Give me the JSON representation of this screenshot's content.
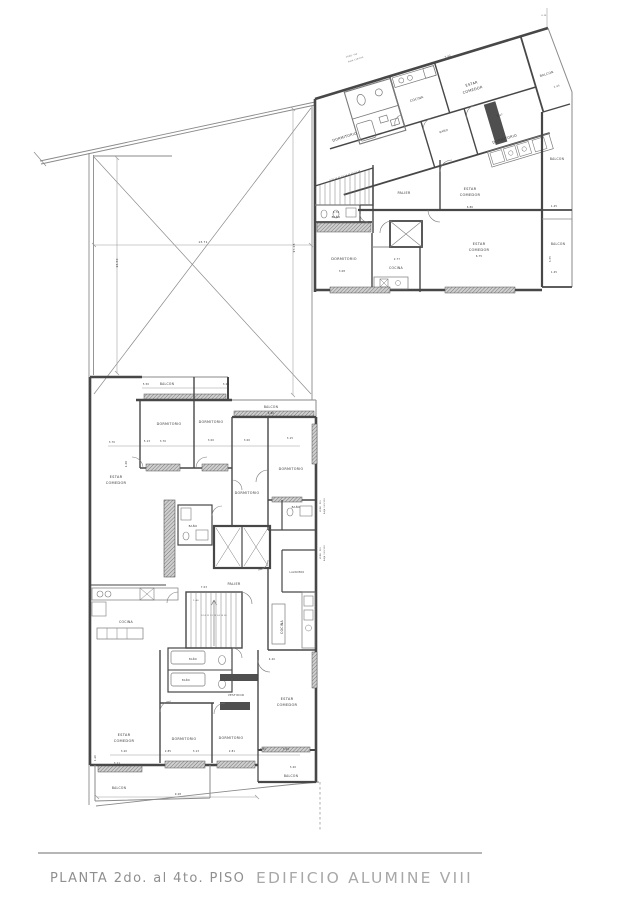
{
  "title": {
    "left": "PLANTA  2do.  al  4to.  PISO",
    "right": "EDIFICIO  ALUMINE  VIII"
  },
  "colors": {
    "wall": "#474747",
    "thin_line": "#8a8a8a",
    "title_left": "#8f8f8f",
    "title_right": "#a8a8a8",
    "background": "#ffffff"
  },
  "plan": {
    "labels": [
      {
        "t": "ESTAR",
        "x": 472,
        "y": 85,
        "r": -17,
        "s": 3.6,
        "c": "room"
      },
      {
        "t": "COMEDOR",
        "x": 473,
        "y": 91,
        "r": -17,
        "s": 3.6,
        "c": "room"
      },
      {
        "t": "COCINA",
        "x": 417,
        "y": 100,
        "r": -17,
        "s": 3.2,
        "c": "room"
      },
      {
        "t": "BALCON",
        "x": 547,
        "y": 75,
        "r": -17,
        "s": 3.1,
        "c": "room"
      },
      {
        "t": "DORMITORIO",
        "x": 345,
        "y": 138,
        "r": -17,
        "s": 3.5,
        "c": "room"
      },
      {
        "t": "BAÑO",
        "x": 444,
        "y": 132,
        "r": -17,
        "s": 2.7,
        "c": "room"
      },
      {
        "t": "DORMITORIO",
        "x": 505,
        "y": 140,
        "r": -17,
        "s": 3.5,
        "c": "room"
      },
      {
        "t": "BALCON",
        "x": 557,
        "y": 160,
        "s": 3.1,
        "c": "room"
      },
      {
        "t": "BALCON",
        "x": 558,
        "y": 245,
        "s": 3.1,
        "c": "room"
      },
      {
        "t": "PALIER",
        "x": 404,
        "y": 194,
        "s": 3.4,
        "c": "room"
      },
      {
        "t": "ESTAR",
        "x": 470,
        "y": 190,
        "s": 3.6,
        "c": "room"
      },
      {
        "t": "COMEDOR",
        "x": 470,
        "y": 196,
        "s": 3.6,
        "c": "room"
      },
      {
        "t": "BAÑO",
        "x": 336,
        "y": 218,
        "s": 2.7,
        "c": "room"
      },
      {
        "t": "DORMITORIO",
        "x": 344,
        "y": 260,
        "s": 3.5,
        "c": "room"
      },
      {
        "t": "COCINA",
        "x": 396,
        "y": 269,
        "s": 3.2,
        "c": "room"
      },
      {
        "t": "ESTAR",
        "x": 479,
        "y": 245,
        "s": 3.6,
        "c": "room"
      },
      {
        "t": "COMEDOR",
        "x": 479,
        "y": 251,
        "s": 3.6,
        "c": "room"
      },
      {
        "t": "BALCON",
        "x": 167,
        "y": 385,
        "s": 3.1,
        "c": "room"
      },
      {
        "t": "BALCON",
        "x": 271,
        "y": 408,
        "s": 3.1,
        "c": "room"
      },
      {
        "t": "DORMITORIO",
        "x": 169,
        "y": 425,
        "s": 3.4,
        "c": "room"
      },
      {
        "t": "DORMITORIO",
        "x": 211,
        "y": 423,
        "s": 3.4,
        "c": "room"
      },
      {
        "t": "ESTAR",
        "x": 116,
        "y": 478,
        "s": 3.6,
        "c": "room"
      },
      {
        "t": "COMEDOR",
        "x": 116,
        "y": 484,
        "s": 3.6,
        "c": "room"
      },
      {
        "t": "DORMITORIO",
        "x": 291,
        "y": 470,
        "s": 3.4,
        "c": "room"
      },
      {
        "t": "DORMITORIO",
        "x": 247,
        "y": 494,
        "s": 3.4,
        "c": "room"
      },
      {
        "t": "BAÑO",
        "x": 193,
        "y": 527,
        "s": 2.7,
        "c": "room"
      },
      {
        "t": "BAÑO",
        "x": 296,
        "y": 508,
        "s": 2.7,
        "c": "room"
      },
      {
        "t": "LAVADERO",
        "x": 297,
        "y": 573,
        "s": 2.4,
        "c": "room"
      },
      {
        "t": "PALIER",
        "x": 234,
        "y": 585,
        "s": 3.4,
        "c": "room"
      },
      {
        "t": "COCINA",
        "x": 126,
        "y": 623,
        "s": 3.2,
        "c": "room"
      },
      {
        "t": "COCINA",
        "x": 283,
        "y": 627,
        "r": -90,
        "s": 3.2,
        "c": "room"
      },
      {
        "t": "BAÑO",
        "x": 193,
        "y": 660,
        "s": 2.4,
        "c": "room"
      },
      {
        "t": "BAÑO",
        "x": 186,
        "y": 681,
        "s": 2.4,
        "c": "room"
      },
      {
        "t": "VESTIDOR",
        "x": 236,
        "y": 696,
        "s": 2.8,
        "c": "room"
      },
      {
        "t": "ESTAR",
        "x": 287,
        "y": 700,
        "s": 3.6,
        "c": "room"
      },
      {
        "t": "COMEDOR",
        "x": 287,
        "y": 706,
        "s": 3.6,
        "c": "room"
      },
      {
        "t": "ESTAR",
        "x": 124,
        "y": 736,
        "s": 3.6,
        "c": "room"
      },
      {
        "t": "COMEDOR",
        "x": 124,
        "y": 742,
        "s": 3.6,
        "c": "room"
      },
      {
        "t": "DORMITORIO",
        "x": 184,
        "y": 740,
        "s": 3.4,
        "c": "room"
      },
      {
        "t": "DORMITORIO",
        "x": 231,
        "y": 739,
        "s": 3.4,
        "c": "room"
      },
      {
        "t": "BALCON",
        "x": 119,
        "y": 789,
        "s": 3.1,
        "c": "room"
      },
      {
        "t": "BALCON",
        "x": 291,
        "y": 777,
        "s": 3.1,
        "c": "room"
      },
      {
        "t": "13.71",
        "x": 203,
        "y": 243,
        "s": 2.8,
        "c": "dim"
      },
      {
        "t": "13.60",
        "x": 118,
        "y": 263,
        "r": -90,
        "s": 2.8,
        "c": "dim"
      },
      {
        "t": "17.26",
        "x": 295,
        "y": 248,
        "r": -90,
        "s": 2.8,
        "c": "dim"
      },
      {
        "t": "5.42",
        "x": 448,
        "y": 57,
        "r": -17,
        "s": 2.4,
        "c": "dim"
      },
      {
        "t": "5.27",
        "x": 500,
        "y": 116,
        "r": -17,
        "s": 2.4,
        "c": "dim"
      },
      {
        "t": "1.45",
        "x": 557,
        "y": 87,
        "r": -17,
        "s": 2.4,
        "c": "dim"
      },
      {
        "t": "1.45",
        "x": 554,
        "y": 207,
        "s": 2.4,
        "c": "dim"
      },
      {
        "t": "3.55",
        "x": 551,
        "y": 259,
        "r": -90,
        "s": 2.4,
        "c": "dim"
      },
      {
        "t": "1.45",
        "x": 554,
        "y": 273,
        "s": 2.4,
        "c": "dim"
      },
      {
        "t": "6.86",
        "x": 470,
        "y": 208,
        "s": 2.4,
        "c": "dim"
      },
      {
        "t": "6.75",
        "x": 479,
        "y": 257,
        "s": 2.4,
        "c": "dim"
      },
      {
        "t": "3.70",
        "x": 336,
        "y": 213,
        "s": 2.4,
        "c": "dim"
      },
      {
        "t": "3.08",
        "x": 342,
        "y": 272,
        "s": 2.4,
        "c": "dim"
      },
      {
        "t": "2.77",
        "x": 397,
        "y": 260,
        "s": 2.4,
        "c": "dim"
      },
      {
        "t": "5.50",
        "x": 146,
        "y": 385,
        "s": 2.4,
        "c": "dim"
      },
      {
        "t": "3.21",
        "x": 226,
        "y": 385,
        "s": 2.4,
        "c": "dim"
      },
      {
        "t": "4.80",
        "x": 271,
        "y": 414,
        "s": 2.4,
        "c": "dim"
      },
      {
        "t": "3.70",
        "x": 112,
        "y": 443,
        "s": 2.4,
        "c": "dim"
      },
      {
        "t": "5.13",
        "x": 147,
        "y": 442,
        "s": 2.4,
        "c": "dim"
      },
      {
        "t": "3.70",
        "x": 163,
        "y": 442,
        "s": 2.4,
        "c": "dim"
      },
      {
        "t": "3.00",
        "x": 211,
        "y": 441,
        "s": 2.4,
        "c": "dim"
      },
      {
        "t": "3.00",
        "x": 247,
        "y": 441,
        "s": 2.4,
        "c": "dim"
      },
      {
        "t": "3.15",
        "x": 290,
        "y": 439,
        "s": 2.4,
        "c": "dim"
      },
      {
        "t": "4.20",
        "x": 127,
        "y": 464,
        "r": -90,
        "s": 2.4,
        "c": "dim"
      },
      {
        "t": "7.03",
        "x": 204,
        "y": 588,
        "s": 2.4,
        "c": "dim"
      },
      {
        "t": "1.40",
        "x": 196,
        "y": 601,
        "s": 2,
        "c": "dim"
      },
      {
        "t": "4.20",
        "x": 272,
        "y": 660,
        "s": 2.4,
        "c": "dim"
      },
      {
        "t": "3.20",
        "x": 124,
        "y": 752,
        "s": 2.4,
        "c": "dim"
      },
      {
        "t": "2.85",
        "x": 168,
        "y": 752,
        "s": 2.4,
        "c": "dim"
      },
      {
        "t": "3.13",
        "x": 196,
        "y": 752,
        "s": 2.4,
        "c": "dim"
      },
      {
        "t": "2.81",
        "x": 232,
        "y": 752,
        "s": 2.4,
        "c": "dim"
      },
      {
        "t": "0.50",
        "x": 263,
        "y": 750,
        "s": 2.4,
        "c": "dim"
      },
      {
        "t": "3.20",
        "x": 286,
        "y": 750,
        "s": 2.4,
        "c": "dim"
      },
      {
        "t": "3.11",
        "x": 117,
        "y": 764,
        "s": 2.4,
        "c": "dim"
      },
      {
        "t": "9.28",
        "x": 178,
        "y": 795,
        "s": 2.4,
        "c": "dim"
      },
      {
        "t": "3.20",
        "x": 293,
        "y": 768,
        "s": 2.4,
        "c": "dim"
      },
      {
        "t": "1.20",
        "x": 96,
        "y": 758,
        "r": -90,
        "s": 2.2,
        "c": "dim"
      },
      {
        "t": "0.15",
        "x": 544,
        "y": 16,
        "s": 1.8,
        "c": "dim"
      },
      {
        "t": "9 10 11 12 13 14 15 16 17 18",
        "x": 345,
        "y": 176,
        "r": -17,
        "s": 1.7,
        "c": "dim"
      },
      {
        "t": "9 10 11 12 13 14 15 16",
        "x": 214,
        "y": 616,
        "s": 1.7,
        "c": "dim"
      },
      {
        "t": "VERD. PLV",
        "x": 352,
        "y": 56,
        "r": -17,
        "s": 1.9,
        "c": "note"
      },
      {
        "t": "BAJA 120/200",
        "x": 356,
        "y": 60,
        "r": -17,
        "s": 1.9,
        "c": "note"
      },
      {
        "t": "VERD. PLV",
        "x": 321,
        "y": 506,
        "r": -90,
        "s": 1.9,
        "c": "note"
      },
      {
        "t": "BAJA 120/200",
        "x": 325,
        "y": 506,
        "r": -90,
        "s": 1.9,
        "c": "note"
      },
      {
        "t": "VERD. PLV",
        "x": 321,
        "y": 553,
        "r": -90,
        "s": 1.9,
        "c": "note"
      },
      {
        "t": "BAJA 120/200",
        "x": 325,
        "y": 553,
        "r": -90,
        "s": 1.9,
        "c": "note"
      }
    ]
  }
}
